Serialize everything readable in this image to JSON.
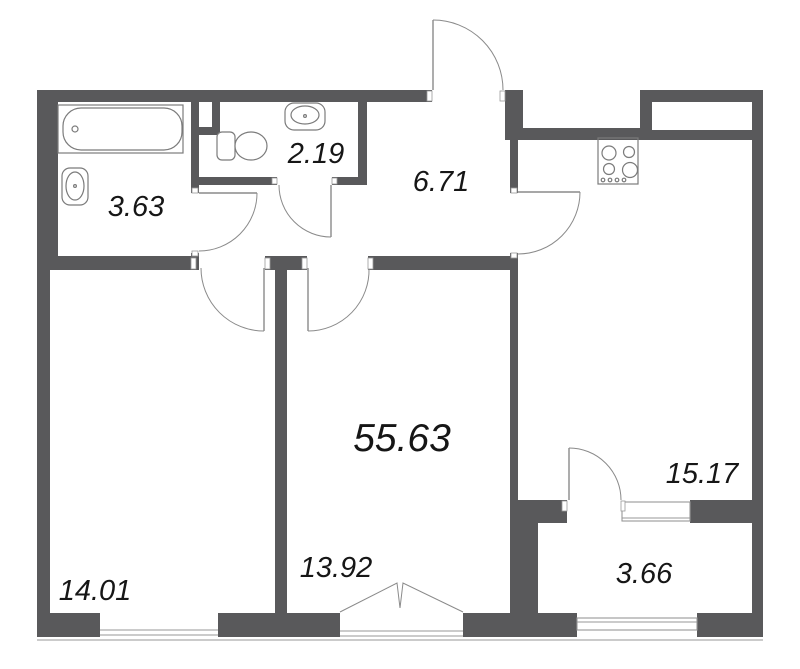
{
  "plan": {
    "total_area": "55.63",
    "rooms": [
      {
        "name": "bathroom",
        "area": "3.63"
      },
      {
        "name": "wc",
        "area": "2.19"
      },
      {
        "name": "hallway",
        "area": "6.71"
      },
      {
        "name": "kitchen-living-room",
        "area": "15.17"
      },
      {
        "name": "room-left",
        "area": "14.01"
      },
      {
        "name": "room-middle",
        "area": "13.92"
      },
      {
        "name": "balcony",
        "area": "3.66"
      }
    ],
    "fixtures": [
      "bathtub",
      "sink",
      "toilet",
      "stove-4-burner"
    ],
    "colors": {
      "wall": "#59595b",
      "fixture-line": "#7b7b7b",
      "door-line": "#8a8a8a",
      "window-line": "#979797",
      "text": "#161616",
      "background": "#ffffff"
    }
  }
}
